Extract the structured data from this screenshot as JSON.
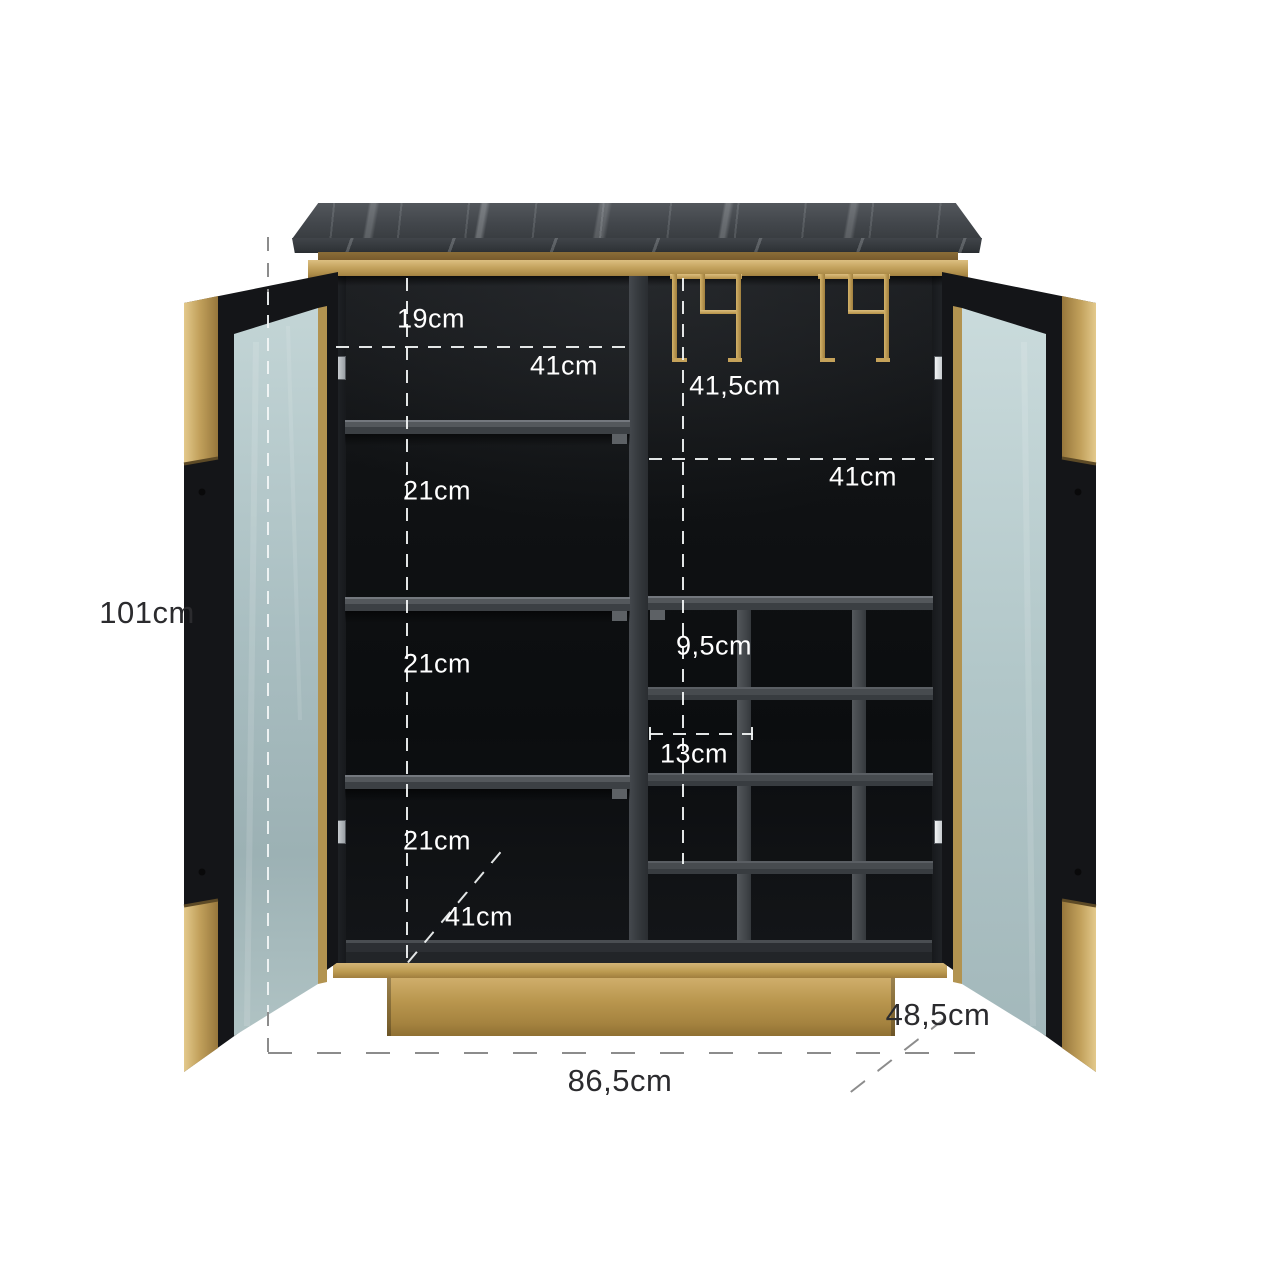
{
  "title": "Bar cabinet dimension diagram",
  "labels": {
    "top_section_height": "19cm",
    "left_compartment_width": "41cm",
    "right_top_section_height": "41,5cm",
    "right_compartment_width": "41cm",
    "shelf_gap_upper": "21cm",
    "shelf_gap_middle": "21cm",
    "shelf_gap_lower": "21cm",
    "wine_rack_cell_height": "9,5cm",
    "wine_rack_cell_width": "13cm",
    "bottom_compartment_width": "41cm",
    "overall_height": "101cm",
    "overall_width": "86,5cm",
    "overall_depth": "48,5cm"
  },
  "colors": {
    "background": "#ffffff",
    "marble": "#43474c",
    "gold": "#c2a15c",
    "interior": "#111316",
    "shelf": "#54585c",
    "glass": "#b9cdcf",
    "dash_light": "#f4f7f7",
    "dash_dark": "#8c8c8c",
    "label_light": "#ffffff",
    "label_dark": "#2b2b2e"
  }
}
